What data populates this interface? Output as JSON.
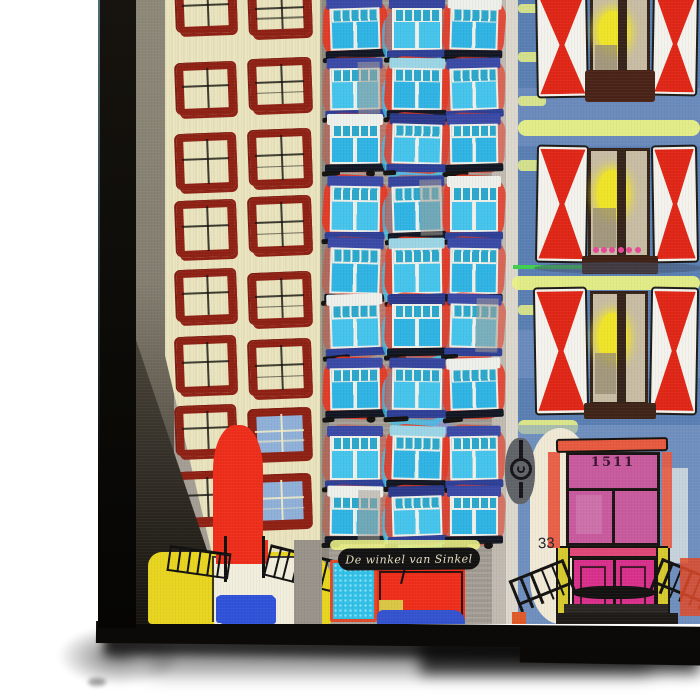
{
  "scene": {
    "description": "Product photo of a canvas print shown at a slight angle on a white background: a colorful naive-style digital painting of three Dutch canal-house facades, with the black canvas side edge visible on the left and a soft drop shadow below.",
    "background_color": "#ffffff"
  },
  "canvas_frame": {
    "edge_color": "#0b0a08",
    "edge_highlight": "#4e6e78",
    "shadow_color": "rgba(0,0,0,0.8)"
  },
  "painting": {
    "sign_text": "De winkel van Sinkel",
    "door_year": "1511",
    "house_number": "33",
    "buildings": {
      "left": {
        "style": "cream facade with sketchy dark-red window frames",
        "window_cols": 2,
        "window_rows": 8
      },
      "middle": {
        "style": "grey facade with cyan windows and red paint splashes",
        "window_cols": 3,
        "window_rows": 9
      },
      "right": {
        "style": "blue facade with red-white hourglass shutters and pink door",
        "window_rows": 3
      }
    },
    "palette": {
      "gray_strip": "#8e8879",
      "left_facade": "#eae4bf",
      "left_frame": "#8e2014",
      "left_frame_dark": "#7e1b10",
      "window_blue_fill": "#8fb0d8",
      "red_accent": "#ee2e1a",
      "yellow_accent": "#e8d51f",
      "cream_accent": "#f2eedd",
      "blue_accent": "#2f52d9",
      "middle_facade": "#a49e95",
      "middle_edge_light": "#c3beb5",
      "splash_red": "#e63824",
      "glass_cyan": "#3fc0ea",
      "lintel_blue": "#3a4aa6",
      "sill_blue": "#2e3f96",
      "frame_white": "#eef0ea",
      "periwinkle": "#8b94d8",
      "ink_black": "#141210",
      "sign_bg": "#121212",
      "sign_text_color": "#e8dfc2",
      "cyan_door": "#2fc0e8",
      "cyan_door_dot": "#8fe0f4",
      "orange_border": "#e04a28",
      "storefront_blue": "#3353cf",
      "white_strip": "#ddd8cd",
      "right_facade": "#5b7fb3",
      "right_light": "#7f9cc9",
      "stripe_yellow": "#eaf285",
      "green_line": "#3ed04e",
      "shutter_white": "#f4f2ec",
      "shutter_red": "#e02616",
      "window_beige": "#c8bda4",
      "window_brown": "#35231a",
      "glow_yellow": "#f0e428",
      "flower_pink": "#e84898",
      "pediment_orange": "#e85a40",
      "transom_pink": "#c85a9e",
      "door_pink": "#d9308c",
      "band_pink": "#e04878",
      "pillar_yellow": "#d6ca2e",
      "step_dark": "#24211d",
      "anchor_gray": "#606468",
      "cream_blob": "#efe9d5"
    }
  }
}
